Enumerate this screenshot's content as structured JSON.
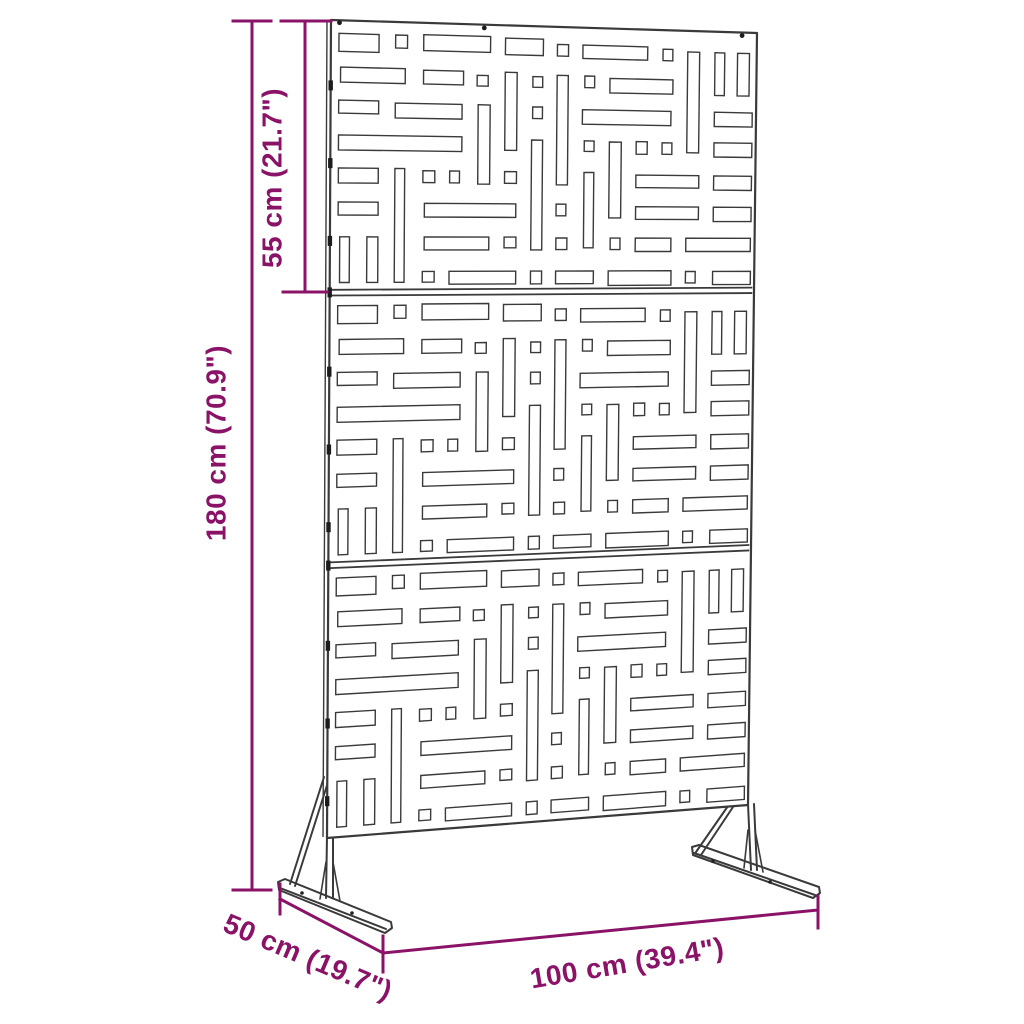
{
  "diagram": {
    "type": "product-dimension-diagram",
    "subject": "freestanding outdoor privacy screen with three laser-cut patterned panels on two feet",
    "dimensions": {
      "total_height": "180 cm (70.9\")",
      "panel_height": "55 cm (21.7\")",
      "width": "100 cm (39.4\")",
      "depth": "50 cm (19.7\")"
    },
    "colors": {
      "dimension_accent": "#8A1368",
      "line": "#3a3a3a",
      "background": "#FFFFFF"
    }
  }
}
